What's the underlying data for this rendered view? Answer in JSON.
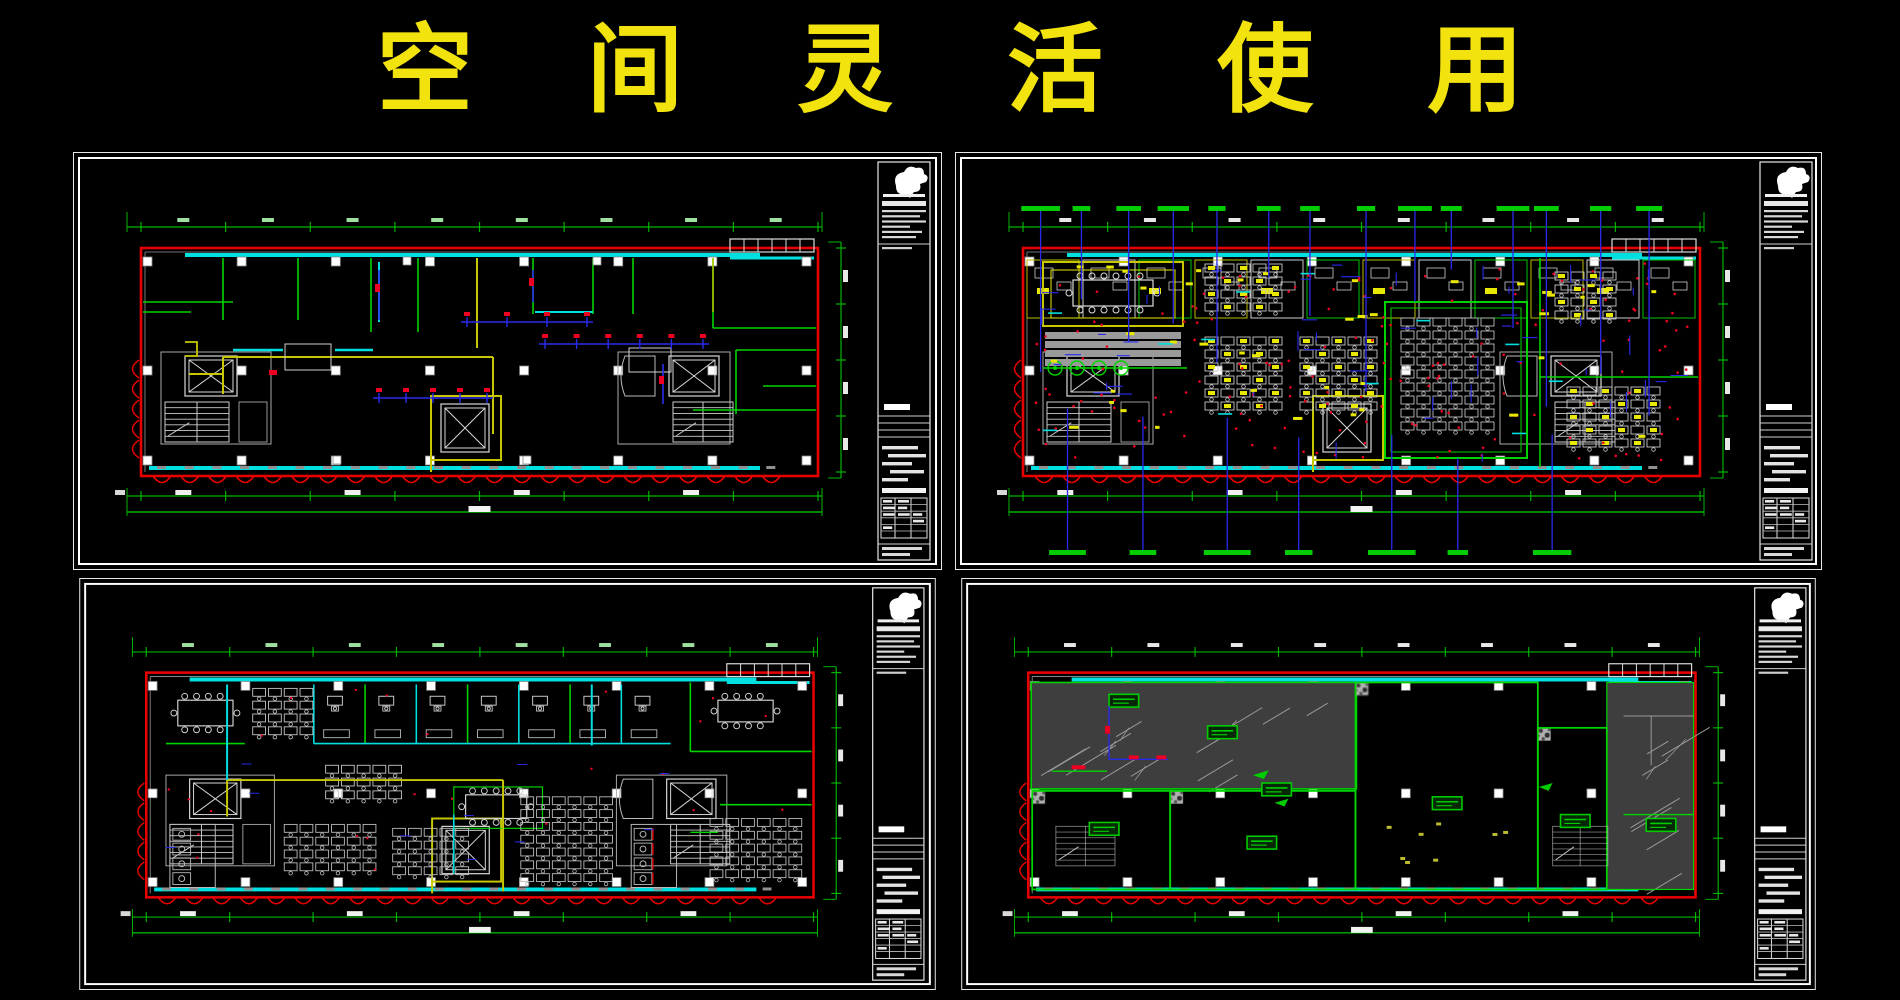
{
  "title": {
    "text": "空 间 灵 活 使 用",
    "color": "#f2e30e"
  },
  "colors": {
    "background": "#000000",
    "frame_white": "#e8e8e8",
    "wall_red": "#e60000",
    "partition_green": "#00d400",
    "dim_green": "#00b400",
    "band_cyan": "#00e0e0",
    "core_yellow": "#c8c800",
    "furniture_yellow": "#e8e800",
    "detail_blue": "#2a2aee",
    "marker_red": "#ee0022",
    "furniture_gray": "#b8b8b8",
    "slab_dark_gray": "#3e3e3e",
    "slab_slash_gray": "#9a9a9a",
    "carpet_base_gray": "#b0b0b0",
    "carpet_dot_gray": "#3a3a3a",
    "label_bar_green": "#00cc00"
  },
  "panels": [
    {
      "id": "top-left",
      "kind": "partition-structure-plan"
    },
    {
      "id": "top-right",
      "kind": "detailed-layout-plan",
      "top_label_count": 14,
      "bottom_label_count": 7
    },
    {
      "id": "bottom-left",
      "kind": "furniture-layout-plan"
    },
    {
      "id": "bottom-right",
      "kind": "floor-finish-plan",
      "finish_tag_count": 8
    }
  ],
  "dimensions": {
    "top_segment_count": 8,
    "bottom_segment_count": 8,
    "right_segment_count": 4,
    "scallop_count": 23,
    "column_count": 8
  },
  "title_block": {
    "has_logo": true,
    "header_line_count": 6,
    "signature_row_count": 5,
    "table_row_count": 6
  }
}
